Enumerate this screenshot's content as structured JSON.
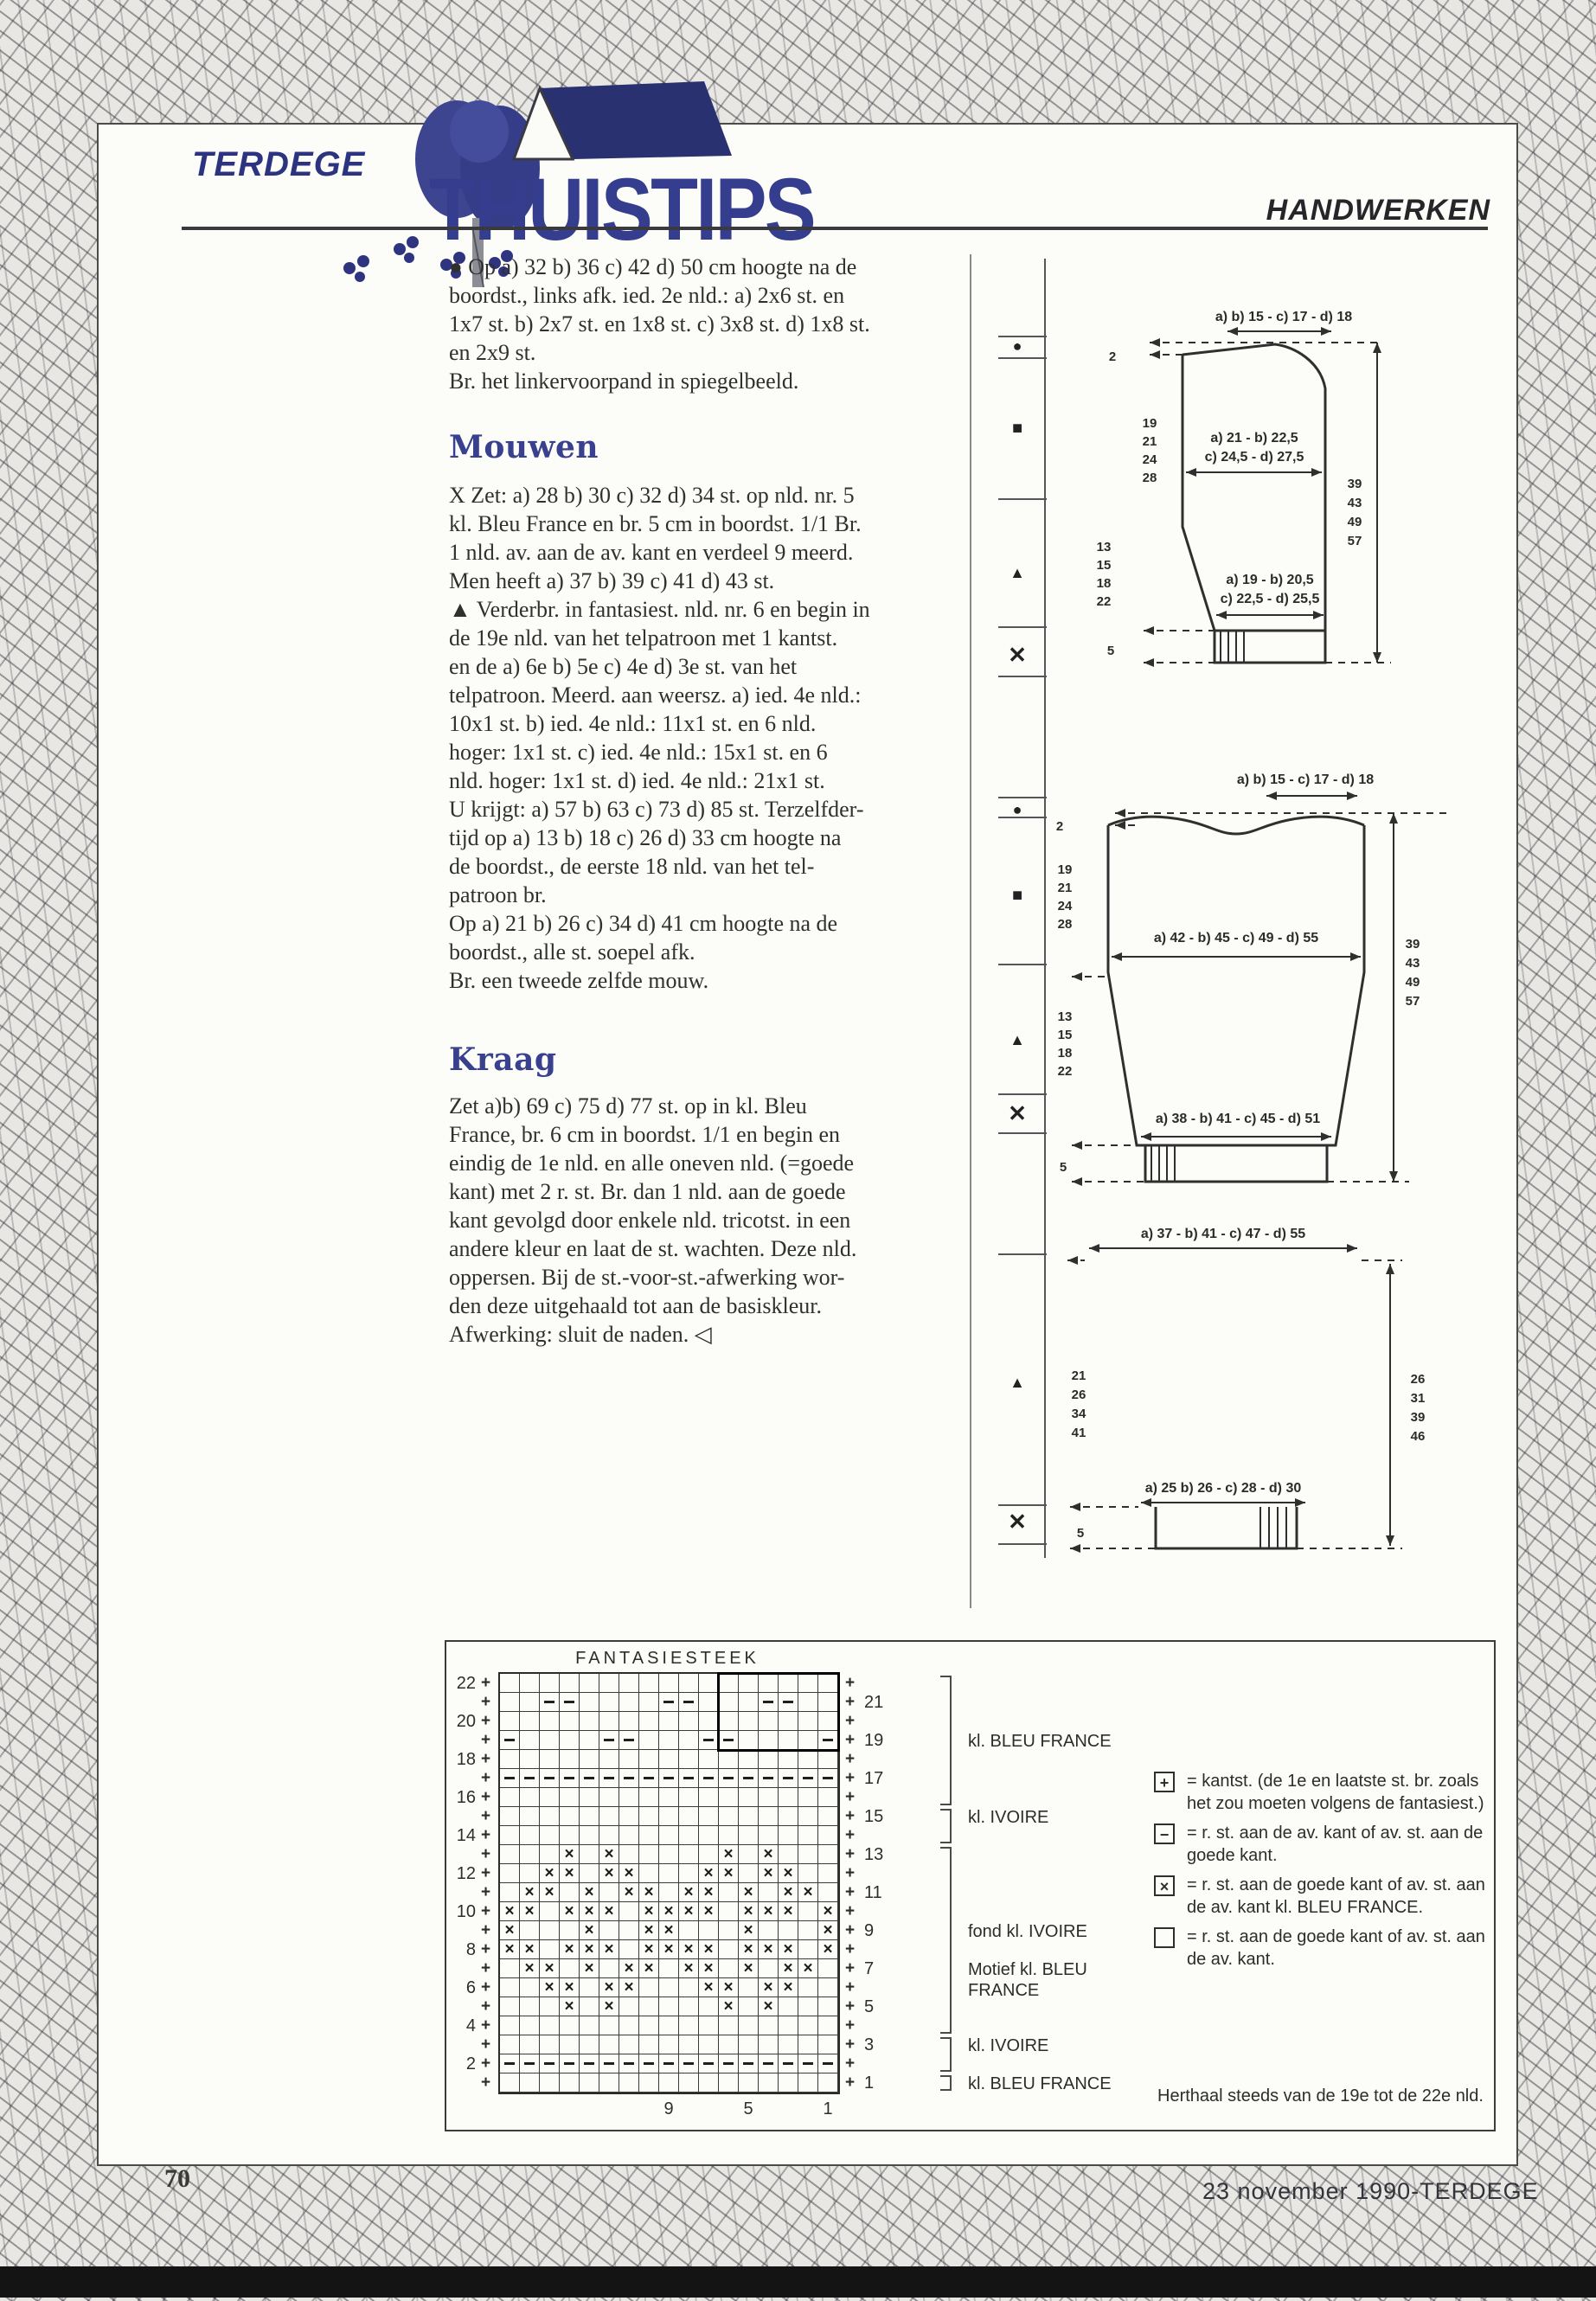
{
  "header": {
    "brand": "TERDEGE",
    "title": "THUISTIPS",
    "section": "HANDWERKEN"
  },
  "article": {
    "intro_lines": [
      "● Op a) 32 b) 36 c) 42 d) 50 cm hoogte na de",
      "boordst., links afk. ied. 2e nld.: a) 2x6 st. en",
      "1x7 st. b) 2x7 st. en 1x8 st. c) 3x8 st. d) 1x8 st.",
      "en 2x9 st.",
      "Br. het linkervoorpand in spiegelbeeld."
    ],
    "sections": [
      {
        "heading": "Mouwen",
        "lines": [
          "X Zet: a) 28 b) 30 c) 32 d) 34 st. op nld. nr. 5",
          "kl. Bleu France en br. 5 cm in boordst. 1/1 Br.",
          "1 nld. av. aan de av. kant en verdeel 9 meerd.",
          "Men heeft a) 37 b) 39 c) 41 d) 43 st.",
          "▲ Verderbr. in fantasiest. nld. nr. 6 en begin in",
          "de 19e nld. van het telpatroon met 1 kantst.",
          "en de a) 6e b) 5e c) 4e d) 3e st. van het",
          "telpatroon. Meerd. aan weersz. a) ied. 4e nld.:",
          "10x1 st. b) ied. 4e nld.: 11x1 st. en 6 nld.",
          "hoger: 1x1 st. c) ied. 4e nld.: 15x1 st. en 6",
          "nld. hoger: 1x1 st. d) ied. 4e nld.: 21x1 st.",
          "U krijgt: a) 57 b) 63 c) 73 d) 85 st. Terzelfder-",
          "tijd op a) 13 b) 18 c) 26 d) 33 cm hoogte na",
          "de boordst., de eerste 18 nld. van het tel-",
          "patroon br.",
          "Op a) 21 b) 26 c) 34 d) 41 cm hoogte na de",
          "boordst., alle st. soepel afk.",
          "Br. een tweede zelfde mouw."
        ]
      },
      {
        "heading": "Kraag",
        "lines": [
          "Zet a)b) 69 c) 75 d) 77 st. op in kl. Bleu",
          "France, br. 6 cm in boordst. 1/1 en begin en",
          "eindig de 1e nld. en alle oneven nld. (=goede",
          "kant) met 2 r. st. Br. dan 1 nld. aan de goede",
          "kant gevolgd door enkele nld. tricotst. in een",
          "andere kleur en laat de st. wachten. Deze nld.",
          "oppersen. Bij de st.-voor-st.-afwerking wor-",
          "den deze uitgehaald tot aan de basiskleur.",
          "Afwerking: sluit de naden. ◁"
        ]
      }
    ]
  },
  "diagrams": {
    "front": {
      "top_width": "a) b) 15 - c) 17 - d) 18",
      "neck_rows": "2",
      "upper_rows": [
        "19",
        "21",
        "24",
        "28"
      ],
      "mid_width_1": "a) 21 - b) 22,5",
      "mid_width_2": "c) 24,5 - d) 27,5",
      "lower_rows": [
        "13",
        "15",
        "18",
        "22"
      ],
      "low_width_1": "a) 19 - b) 20,5",
      "low_width_2": "c) 22,5 - d) 25,5",
      "total_height": [
        "39",
        "43",
        "49",
        "57"
      ],
      "rib": "5"
    },
    "back": {
      "top_width": "a) b) 15 - c) 17 - d) 18",
      "neck_rows": "2",
      "upper_rows": [
        "19",
        "21",
        "24",
        "28"
      ],
      "mid_width": "a) 42 - b) 45 - c) 49 - d) 55",
      "lower_rows": [
        "13",
        "15",
        "18",
        "22"
      ],
      "bottom_width": "a) 38 - b) 41 - c) 45 - d) 51",
      "total_height": [
        "39",
        "43",
        "49",
        "57"
      ],
      "rib": "5"
    },
    "sleeve": {
      "top_width": "a) 37 - b) 41 - c) 47 - d) 55",
      "left_rows": [
        "21",
        "26",
        "34",
        "41"
      ],
      "right_height": [
        "26",
        "31",
        "39",
        "46"
      ],
      "bottom_width": "a) 25 b) 26 - c) 28 - d) 30",
      "rib": "5"
    }
  },
  "chart": {
    "title": "FANTASIESTEEK",
    "rows": [
      ".................",
      "..--....--...--..",
      ".................",
      "-....--...--....-",
      ".................",
      "-----------------",
      ".................",
      ".................",
      ".................",
      "...x.x.....x.x...",
      "..xx.xx...xx.xx..",
      ".xx.x.xx.xx.x.xx.",
      "xx.xxx.xxxx.xxx.x",
      "x...x..xx...x...x",
      "xx.xxx.xxxx.xxx.x",
      ".xx.x.xx.xx.x.xx.",
      "..xx.xx...xx.xx..",
      "...x.x.....x.x...",
      ".................",
      ".................",
      "-----------------",
      "................."
    ],
    "left_row_labels": [
      "22",
      "",
      "20",
      "",
      "18",
      "",
      "16",
      "",
      "14",
      "",
      "12",
      "",
      "10",
      "",
      "8",
      "",
      "6",
      "",
      "4",
      "",
      "2",
      ""
    ],
    "right_row_labels": [
      "",
      "21",
      "",
      "19",
      "",
      "17",
      "",
      "15",
      "",
      "13",
      "",
      "11",
      "",
      "9",
      "",
      "7",
      "",
      "5",
      "",
      "3",
      "",
      "1"
    ],
    "bottom_labels": [
      {
        "text": "9",
        "col": 9
      },
      {
        "text": "5",
        "col": 13
      },
      {
        "text": "1",
        "col": 17
      }
    ],
    "repeat_box": {
      "row_from": 22,
      "row_to": 19,
      "col_from": 12,
      "col_to": 17
    },
    "brackets": [
      {
        "row_from": 22,
        "row_to": 16
      },
      {
        "row_from": 15,
        "row_to": 14
      },
      {
        "row_from": 13,
        "row_to": 4
      },
      {
        "row_from": 3,
        "row_to": 2
      },
      {
        "row_from": 1,
        "row_to": 1
      }
    ],
    "color_labels": [
      {
        "text": "kl. BLEU FRANCE",
        "row": 19
      },
      {
        "text": "kl. IVOIRE",
        "row": 15
      },
      {
        "text": "fond kl. IVOIRE",
        "row": 9
      },
      {
        "text": "Motief kl. BLEU\nFRANCE",
        "row": 7
      },
      {
        "text": "kl. IVOIRE",
        "row": 3
      },
      {
        "text": "kl. BLEU FRANCE",
        "row": 1
      }
    ],
    "legend": [
      {
        "symbol": "plus",
        "lines": [
          "= kantst. (de 1e en laatste st. br. zoals",
          "het zou moeten volgens de fantasiest.)"
        ]
      },
      {
        "symbol": "dash",
        "lines": [
          "= r. st. aan de av. kant of av. st. aan de",
          "goede kant."
        ]
      },
      {
        "symbol": "x",
        "lines": [
          "= r. st. aan de goede kant of av. st. aan",
          "de av. kant kl. BLEU FRANCE."
        ]
      },
      {
        "symbol": "empty",
        "lines": [
          "= r. st. aan de goede kant of av. st. aan",
          "de av. kant."
        ]
      }
    ],
    "repeat_note": "Herthaal steeds van de 19e tot de 22e nld."
  },
  "footer": {
    "page_number": "70",
    "credit": "23 november 1990-TERDEGE"
  },
  "colors": {
    "accent_blue": "#353e8e",
    "heading_blue": "#39418f",
    "ink": "#2f2f2f"
  }
}
